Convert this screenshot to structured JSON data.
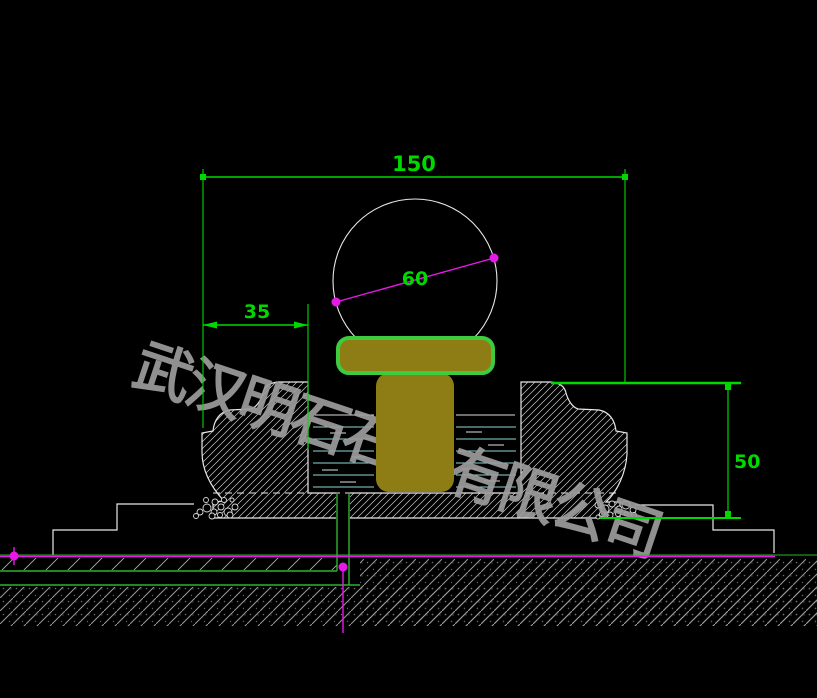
{
  "watermark": {
    "text": "武汉明石石业有限公司"
  },
  "dimensions": {
    "overall_width": {
      "value": "150"
    },
    "rim_offset": {
      "value": "35"
    },
    "ball_diameter": {
      "value": "60"
    },
    "basin_height": {
      "value": "50"
    }
  },
  "colors": {
    "background": "#000000",
    "dimension_green": "#00d900",
    "pipe_green": "#2db32d",
    "centerline_magenta": "#e819e8",
    "outline_white": "#e8e8e8",
    "water_cyan": "#8fd8d8",
    "stone_olive": "#8e7d15",
    "cap_green": "#3ecb3e",
    "watermark_gray": "#9d9d9d"
  }
}
